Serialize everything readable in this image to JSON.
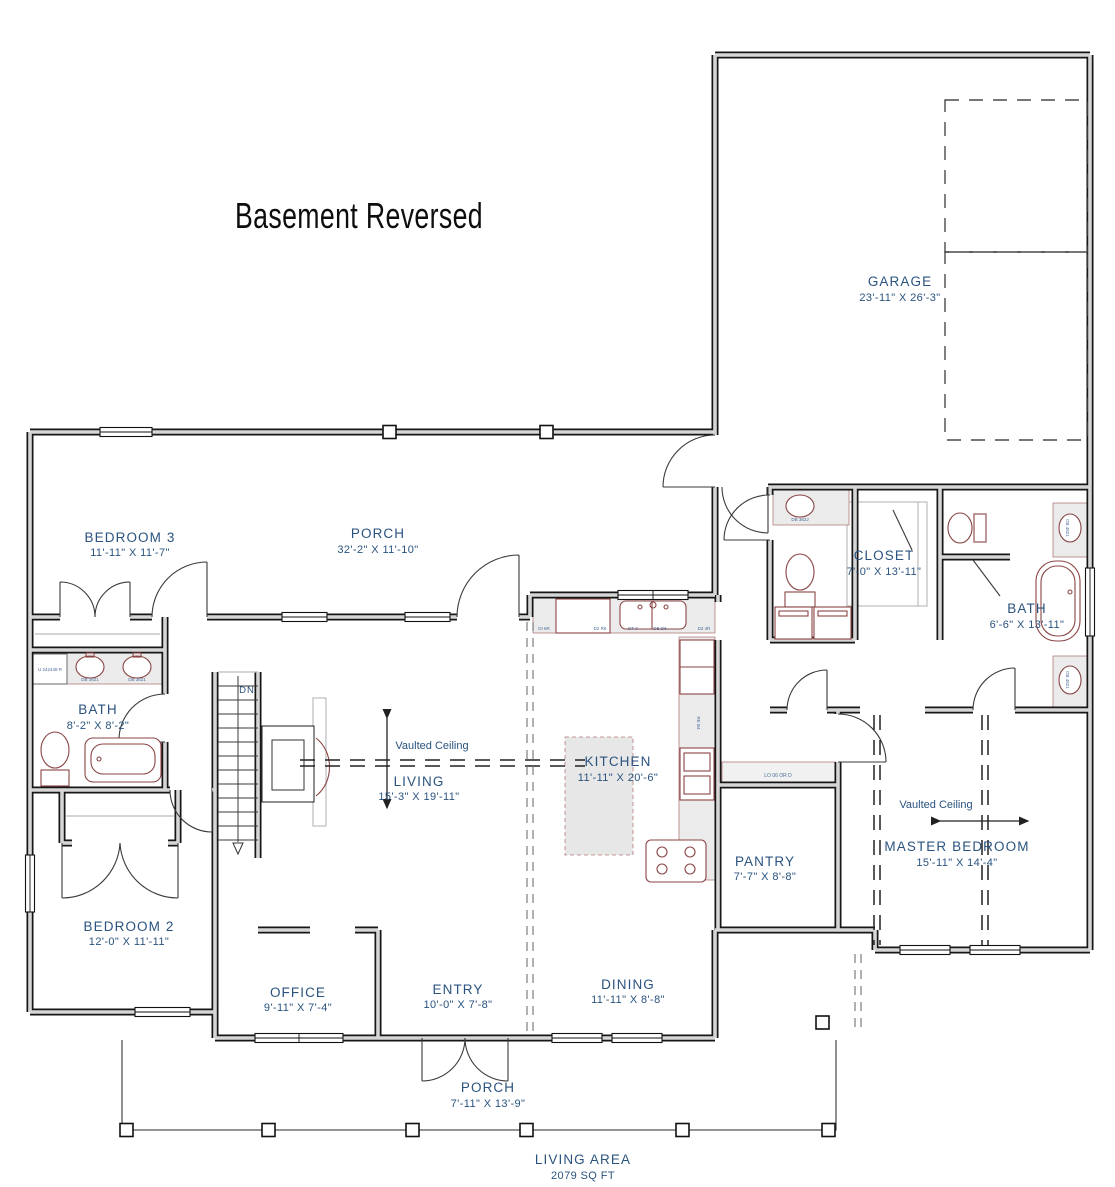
{
  "title": "Basement Reversed",
  "colors": {
    "label_blue": "#2a537f",
    "fixture_red": "#8a4444",
    "wall_dark": "#161616",
    "counter_gray": "#ebebeb"
  },
  "rooms": {
    "garage": {
      "name": "GARAGE",
      "dims": "23'-11\" X 26'-3\""
    },
    "bedroom3": {
      "name": "BEDROOM 3",
      "dims": "11'-11\" X 11'-7\""
    },
    "porch_top": {
      "name": "PORCH",
      "dims": "32'-2\" X 11'-10\""
    },
    "closet": {
      "name": "CLOSET",
      "dims": "7'-0\" X 13'-11\""
    },
    "bath_master": {
      "name": "BATH",
      "dims": "6'-6\" X 13'-11\""
    },
    "bath2": {
      "name": "BATH",
      "dims": "8'-2\" X 8'-2\""
    },
    "living": {
      "name": "LIVING",
      "dims": "15'-3\" X 19'-11\""
    },
    "kitchen": {
      "name": "KITCHEN",
      "dims": "11'-11\" X 20'-6\""
    },
    "pantry": {
      "name": "PANTRY",
      "dims": "7'-7\" X 8'-8\""
    },
    "master": {
      "name": "MASTER BEDROOM",
      "dims": "15'-11\" X 14'-4\""
    },
    "bedroom2": {
      "name": "BEDROOM 2",
      "dims": "12'-0\" X 11'-11\""
    },
    "office": {
      "name": "OFFICE",
      "dims": "9'-11\" X 7'-4\""
    },
    "entry": {
      "name": "ENTRY",
      "dims": "10'-0\" X 7'-8\""
    },
    "dining": {
      "name": "DINING",
      "dims": "11'-11\" X 8'-8\""
    },
    "porch_bottom": {
      "name": "PORCH",
      "dims": "7'-11\" X 13'-9\""
    }
  },
  "annotations": {
    "vaulted_ceiling_living": "Vaulted Ceiling",
    "vaulted_ceiling_master": "Vaulted Ceiling",
    "stairs_dn": "DN",
    "living_area_label": "LIVING AREA",
    "living_area_value": "2079 SQ FT"
  },
  "fixture_codes": {
    "bath2_linen": "U 242448 R",
    "bath2_sink_left": "DB 3621",
    "bath2_sink_right": "DB 3621",
    "kitchen_counter": [
      "DI 6R",
      "D2 R6",
      "DT 0",
      "DB D6",
      "D2 4R"
    ],
    "kitchen_fridge": "RE B4",
    "mudroom_sink": "DB 362J",
    "master_vanity_top": "DB 4621",
    "master_vanity_bottom": "DB 4621",
    "drop_zone": "LO 06 OR D"
  }
}
